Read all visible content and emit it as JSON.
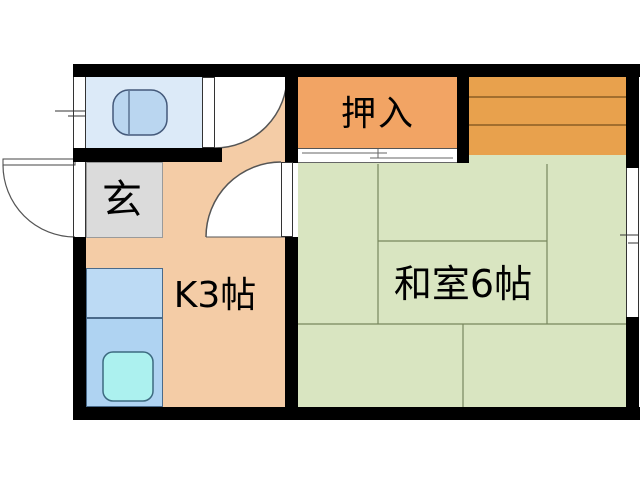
{
  "floorplan": {
    "type": "japanese-apartment-1K-floor-plan",
    "rooms": {
      "genkan": {
        "label": "玄"
      },
      "kitchen": {
        "label": "K3帖"
      },
      "oshiire": {
        "label": "押入"
      },
      "washitsu": {
        "label": "和室6帖"
      },
      "toilet": {
        "label": ""
      },
      "shelf": {
        "label": ""
      }
    },
    "colors": {
      "wall": "#000000",
      "kitchen_floor": "#F4CCA6",
      "washitsu_floor": "#D9E5C1",
      "oshiire_closet": "#F2A464",
      "shelf_area": "#E8A14D",
      "toilet_room": "#DCEAF8",
      "genkan_floor": "#DBDBDB",
      "counter_upper": "#BCDAF4",
      "counter_lower": "#AFD3F2",
      "sink": "#ACF1EF",
      "toilet_fixture": "#BAD6F0",
      "tatami_line": "#77865E",
      "shelf_line": "#5C3C10",
      "door_arc": "#555555"
    },
    "icons": {
      "toilet": "toilet-icon",
      "sink": "sink-icon",
      "entrance_door": "entrance-door-arc",
      "toilet_door": "toilet-door-arc",
      "room_door": "room-door-arc",
      "sliding_door": "fusuma-track-lines",
      "window": "window-symbol"
    }
  }
}
